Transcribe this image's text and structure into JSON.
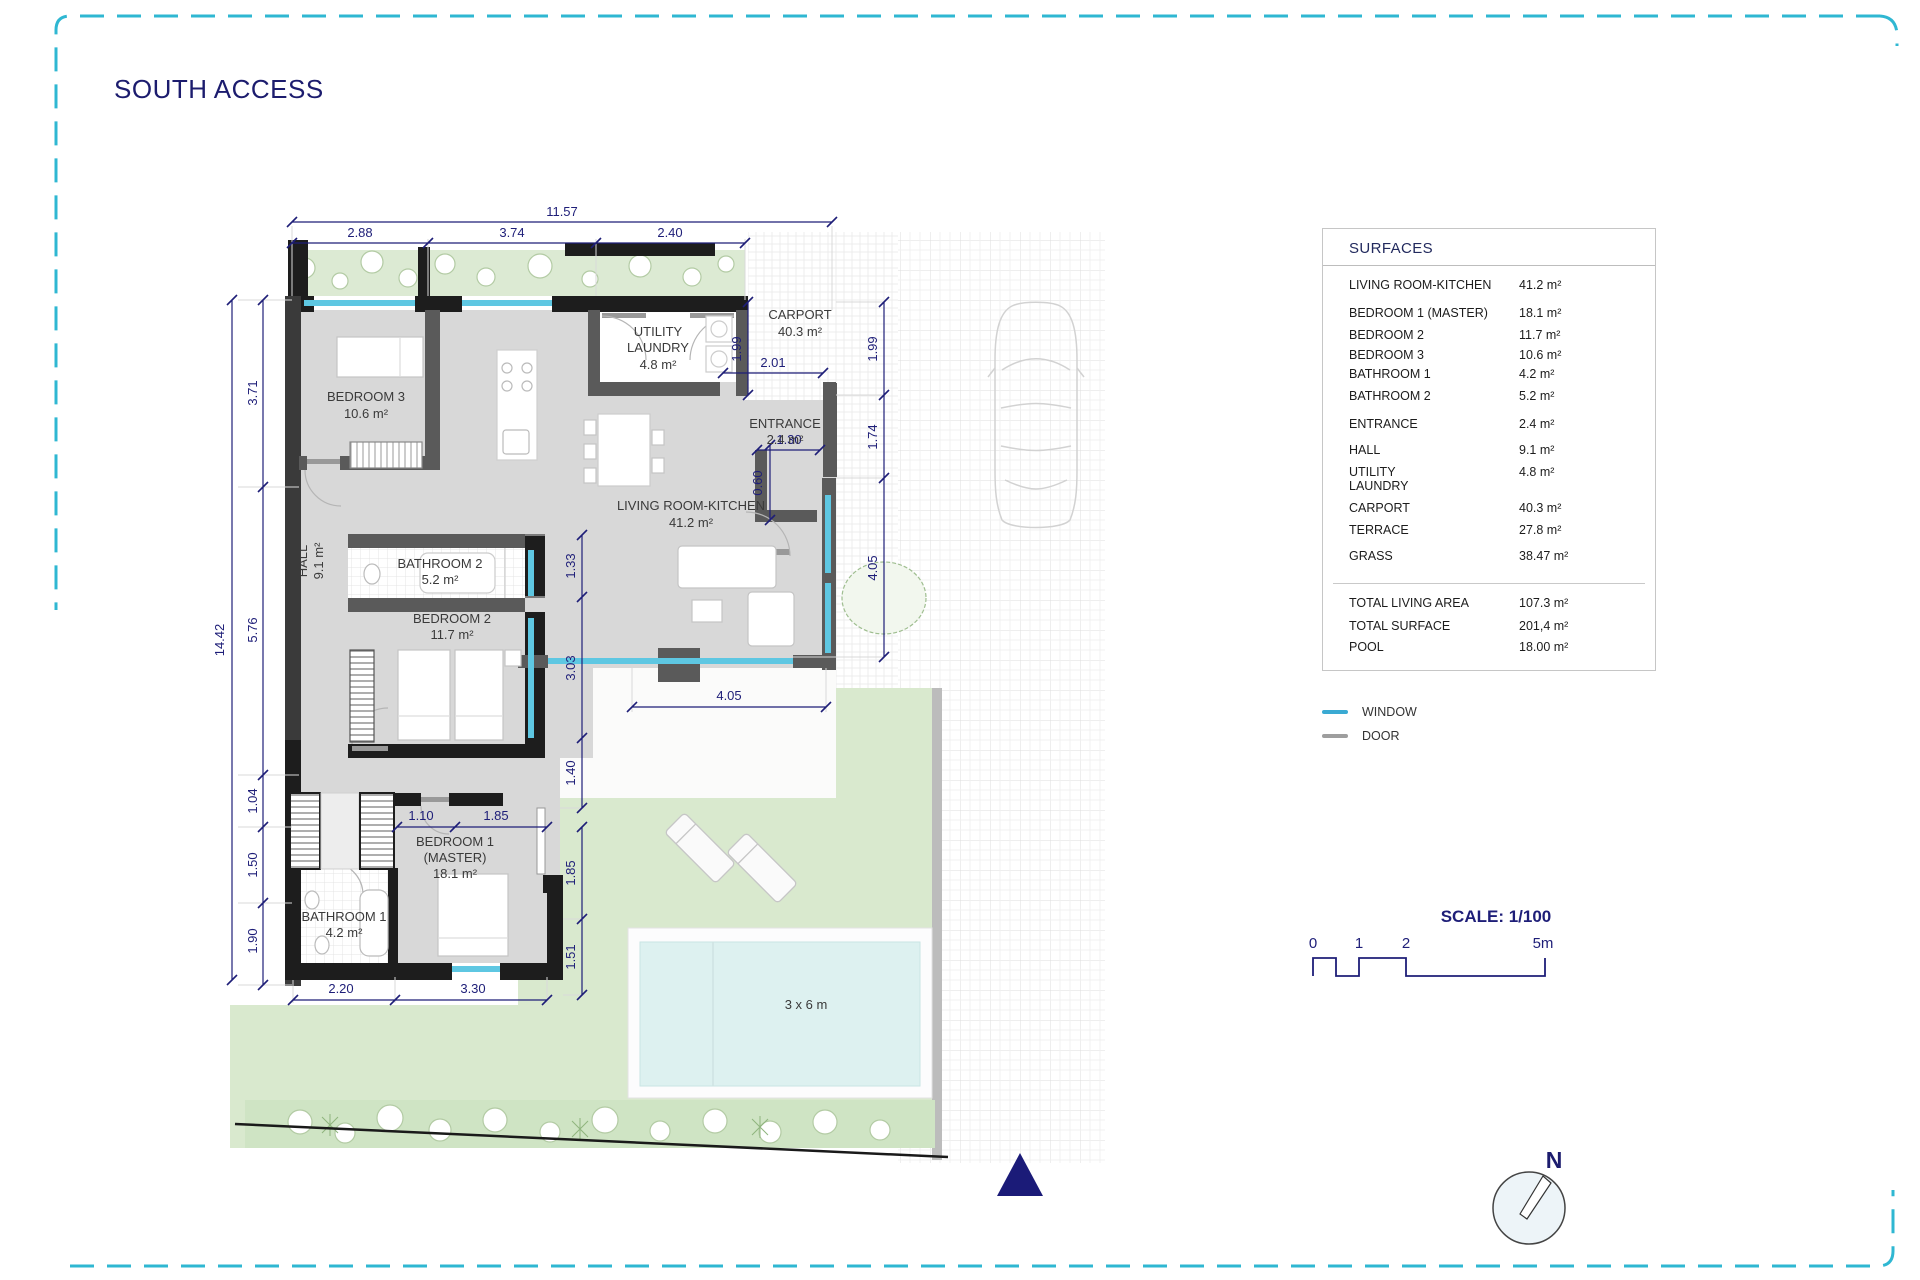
{
  "title": "SOUTH ACCESS",
  "colors": {
    "accent_navy": "#1e1e78",
    "window_blue": "#3aaad3",
    "door_gray": "#9e9e9e",
    "border_cyan": "#2fb7d2",
    "wall_dark": "#1d1d1d",
    "floor_gray": "#d8d8d8",
    "grass_green": "#d9e9ce",
    "pool_blue": "#ddf1f0"
  },
  "plan": {
    "rooms": {
      "bedroom3": {
        "name": "BEDROOM 3",
        "area": "10.6 m²"
      },
      "utility": {
        "name1": "UTILITY",
        "name2": "LAUNDRY",
        "area": "4.8 m²"
      },
      "carport": {
        "name": "CARPORT",
        "area": "40.3 m²"
      },
      "entrance": {
        "name": "ENTRANCE",
        "area": "2.4 m²"
      },
      "living": {
        "name": "LIVING ROOM-KITCHEN",
        "area": "41.2 m²"
      },
      "hall": {
        "name": "HALL",
        "area": "9.1 m²"
      },
      "bathroom2": {
        "name": "BATHROOM 2",
        "area": "5.2 m²"
      },
      "bedroom2": {
        "name": "BEDROOM 2",
        "area": "11.7 m²"
      },
      "bedroom1": {
        "name1": "BEDROOM 1",
        "name2": "(MASTER)",
        "area": "18.1 m²"
      },
      "bathroom1": {
        "name": "BATHROOM 1",
        "area": "4.2 m²"
      },
      "pool": {
        "label": "3 x 6 m"
      }
    },
    "dims": {
      "w_total": "11.57",
      "w_a": "2.88",
      "w_b": "3.74",
      "w_c": "2.40",
      "h_total": "14.42",
      "h_a": "3.71",
      "h_b": "5.76",
      "h_c": "1.04",
      "h_d": "1.50",
      "h_e": "1.90",
      "r_a": "1.99",
      "r_b": "1.74",
      "r_c": "4.05",
      "c_a": "1.99",
      "c_w": "2.01",
      "e_a": "1.30",
      "e_b": "0.60",
      "t_w": "4.05",
      "i_a": "1.33",
      "i_b": "3.03",
      "i_c": "1.40",
      "m_a": "1.10",
      "m_b": "1.85",
      "m_c": "1.85",
      "m_d": "1.51",
      "b_a": "2.20",
      "b_b": "3.30"
    }
  },
  "surfaces": {
    "header": "SURFACES",
    "rows": [
      {
        "label": "LIVING ROOM-KITCHEN",
        "value": "41.2 m²"
      },
      {
        "label": "BEDROOM 1 (MASTER)",
        "value": "18.1 m²"
      },
      {
        "label": "BEDROOM 2",
        "value": "11.7 m²"
      },
      {
        "label": "BEDROOM 3",
        "value": "10.6 m²"
      },
      {
        "label": "BATHROOM 1",
        "value": "4.2 m²"
      },
      {
        "label": "BATHROOM 2",
        "value": "5.2 m²"
      },
      {
        "label": "ENTRANCE",
        "value": "2.4 m²"
      },
      {
        "label": "HALL",
        "value": "9.1 m²"
      },
      {
        "label": "UTILITY\nLAUNDRY",
        "value": "4.8 m²"
      },
      {
        "label": "CARPORT",
        "value": "40.3 m²"
      },
      {
        "label": "TERRACE",
        "value": "27.8 m²"
      },
      {
        "label": "GRASS",
        "value": "38.47 m²"
      }
    ],
    "totals": [
      {
        "label": "TOTAL LIVING AREA",
        "value": "107.3 m²"
      },
      {
        "label": "TOTAL SURFACE",
        "value": "201,4 m²"
      },
      {
        "label": "POOL",
        "value": "18.00 m²"
      }
    ]
  },
  "legend": {
    "window_label": "WINDOW",
    "door_label": "DOOR"
  },
  "scale": {
    "title": "SCALE: 1/100",
    "t0": "0",
    "t1": "1",
    "t2": "2",
    "t3": "5m"
  },
  "compass": {
    "north": "N"
  }
}
